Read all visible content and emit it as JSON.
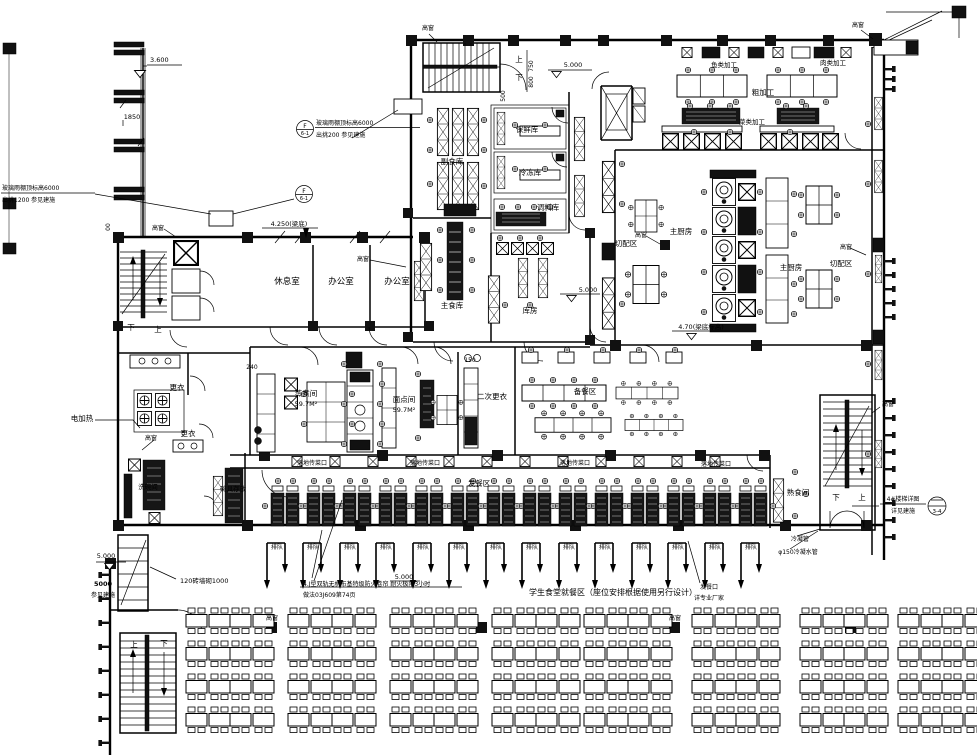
{
  "labels": {
    "rest_room": "休息室",
    "office": "办公室",
    "side_food_store": "副食库",
    "fresh_store": "保鲜库",
    "freezer": "冷冻库",
    "seasoning_store": "调料库",
    "staple_store": "主食库",
    "storeroom": "库房",
    "cutting_area": "切配区",
    "main_kitchen": "主厨房",
    "rough_processing": "粗加工",
    "fish_processing": "鱼类加工",
    "meat_processing": "肉类加工",
    "veg_processing": "菜类加工",
    "steaming_room": "蒸煮间",
    "steaming_area": "59.7M²",
    "pastry_room": "面点间",
    "pastry_area": "59.7M²",
    "second_change": "二次更衣",
    "prep_area": "备餐区",
    "serving_area": "发餐区",
    "serving_port": "落地传菜口",
    "cooked_food_room": "熟食间",
    "change_room": "更衣",
    "electric_heating": "电加热",
    "dishwash_room": "洗碗间",
    "dishware_storage": "碗具存放",
    "queue": "排队",
    "up": "上",
    "down": "下",
    "high_window": "高窗"
  },
  "ann": {
    "elev_3600": "3.600",
    "dim_1850": "1850",
    "dim_750": "750",
    "dim_800": "800",
    "dim_500": "500",
    "dim_240": "240",
    "dim_150": "150",
    "dim_00": "00",
    "elev_5000": "5.000",
    "elev_4250": "4.250(梁底)",
    "elev_470": "4.70(梁底标高)",
    "canopy_a1": "玻璃雨棚顶标高6000",
    "canopy_a2": "出挑200 参见建施",
    "canopy_b1": "玻璃雨棚顶标高6000",
    "canopy_b2": "出挑1200 参见建施",
    "sym_f": "F",
    "sym_61": "6-1",
    "brick_note": "120砖墙砌1000",
    "ref_5000": "5000",
    "see_arch": "参见建施",
    "fire_note1": "4.J型双轨无机布基特级防火卷帘 耐火极限3小时",
    "fire_note2": "做法03J609第74页",
    "dining_note": "学生食堂就餐区（座位安排根据使用另行设计）",
    "stair4_1": "4#楼梯详图",
    "stair4_2": "详见建施",
    "stair4_ref": "3-4",
    "cond1": "冷凝管",
    "cond2": "φ150冷凝水管",
    "serve_win1": "发餐口",
    "serve_win2": "详专业厂家"
  }
}
